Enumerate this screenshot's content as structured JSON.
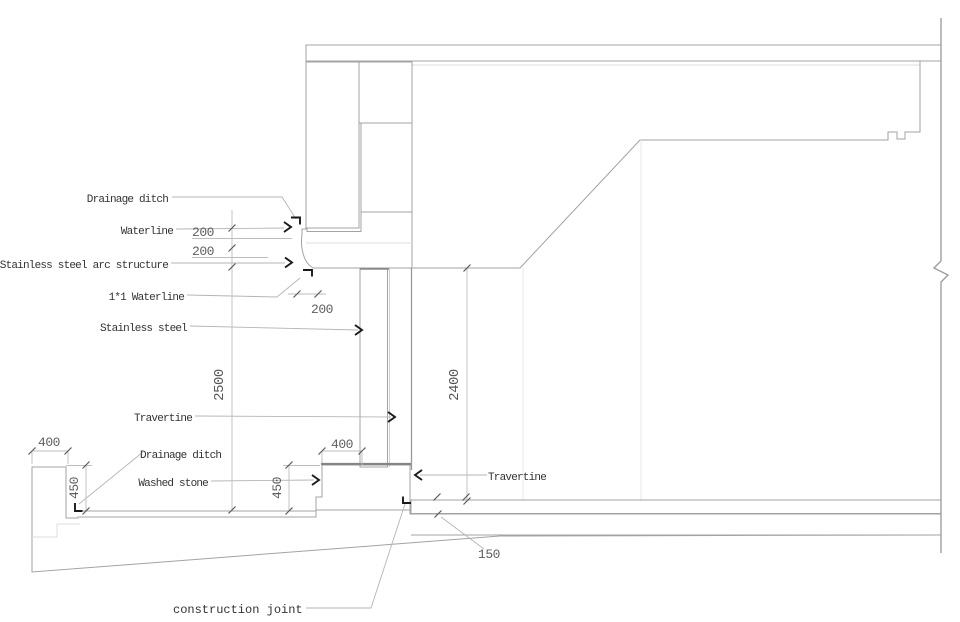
{
  "drawing": {
    "labels": {
      "drainage_ditch_top": "Drainage ditch",
      "waterline": "Waterline",
      "stainless_steel_arc": "Stainless steel arc structure",
      "waterline_1x1": "1*1 Waterline",
      "stainless_steel": "Stainless steel",
      "travertine_left": "Travertine",
      "drainage_ditch_bottom": "Drainage ditch",
      "washed_stone": "Washed stone",
      "travertine_right": "Travertine",
      "construction_joint": "construction joint"
    },
    "dimensions": {
      "d200_upper": "200",
      "d200_lower": "200",
      "d200_arc": "200",
      "d2500": "2500",
      "d2400": "2400",
      "d400_curb": "400",
      "d450_curb": "450",
      "d400_plinth": "400",
      "d450_plinth": "450",
      "d150_floor": "150"
    },
    "colors": {
      "background": "#ffffff",
      "outline": "#a3a3a3",
      "hatch_line": "#d6d6d6",
      "stipple_dot": "#b8b8b8",
      "travertine_fill": "#f3f3f0",
      "leader": "#b5b5b5",
      "label_text": "#333333",
      "dim_text": "#5f5f5f",
      "marker": "#1a1a1a"
    }
  }
}
